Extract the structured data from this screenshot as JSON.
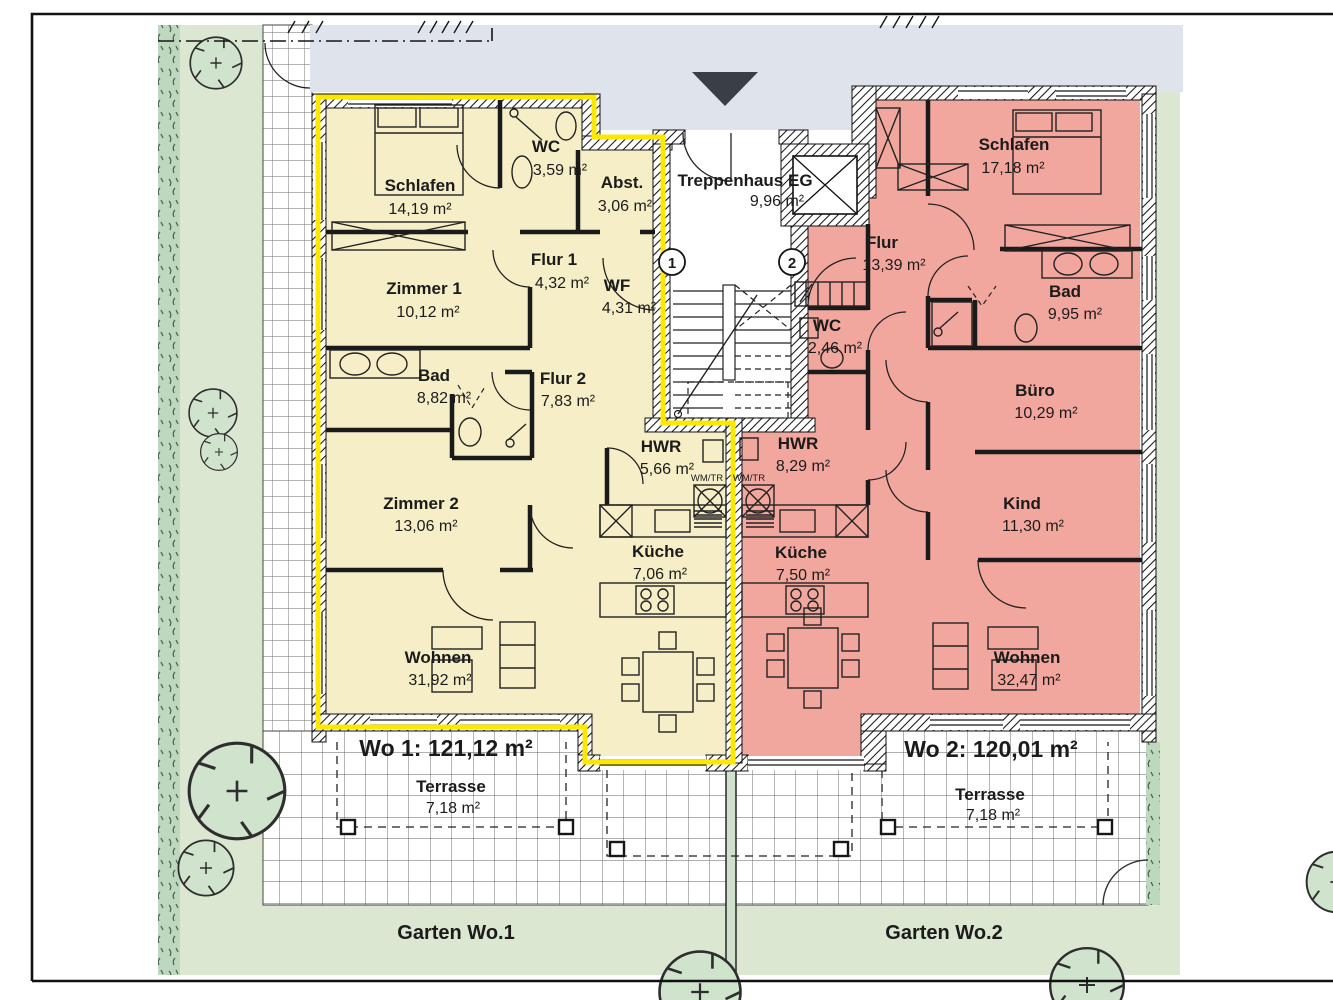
{
  "stairwell": {
    "name": "Treppenhaus EG",
    "area": "9,96 m²",
    "entrance_1": "1",
    "entrance_2": "2"
  },
  "apartment1": {
    "total": "Wo 1: 121,12 m²",
    "garden_label": "Garten Wo.1",
    "terrace": {
      "name": "Terrasse",
      "area": "7,18 m²"
    },
    "wm_label": "WM/TR",
    "rooms": {
      "schlafen": {
        "name": "Schlafen",
        "area": "14,19 m²"
      },
      "wc": {
        "name": "WC",
        "area": "3,59 m²"
      },
      "abst": {
        "name": "Abst.",
        "area": "3,06 m²"
      },
      "zimmer1": {
        "name": "Zimmer 1",
        "area": "10,12 m²"
      },
      "flur1": {
        "name": "Flur 1",
        "area": "4,32 m²"
      },
      "wf": {
        "name": "WF",
        "area": "4,31 m²"
      },
      "bad": {
        "name": "Bad",
        "area": "8,82 m²"
      },
      "flur2": {
        "name": "Flur 2",
        "area": "7,83 m²"
      },
      "zimmer2": {
        "name": "Zimmer 2",
        "area": "13,06 m²"
      },
      "hwr": {
        "name": "HWR",
        "area": "5,66 m²"
      },
      "kueche": {
        "name": "Küche",
        "area": "7,06 m²"
      },
      "wohnen": {
        "name": "Wohnen",
        "area": "31,92 m²"
      }
    }
  },
  "apartment2": {
    "total": "Wo 2: 120,01 m²",
    "garden_label": "Garten Wo.2",
    "terrace": {
      "name": "Terrasse",
      "area": "7,18 m²"
    },
    "wm_label": "WM/TR",
    "rooms": {
      "schlafen": {
        "name": "Schlafen",
        "area": "17,18 m²"
      },
      "flur": {
        "name": "Flur",
        "area": "13,39 m²"
      },
      "bad": {
        "name": "Bad",
        "area": "9,95 m²"
      },
      "wc": {
        "name": "WC",
        "area": "2,46 m²"
      },
      "buero": {
        "name": "Büro",
        "area": "10,29 m²"
      },
      "hwr": {
        "name": "HWR",
        "area": "8,29 m²"
      },
      "kind": {
        "name": "Kind",
        "area": "11,30 m²"
      },
      "kueche": {
        "name": "Küche",
        "area": "7,50 m²"
      },
      "wohnen": {
        "name": "Wohnen",
        "area": "32,47 m²"
      }
    }
  },
  "colors": {
    "apartment1_fill": "#f6eec6",
    "apartment2_fill": "#f2a79e",
    "highlight_outline": "#ffe800",
    "garden": "#dbe7d1",
    "hedge": "#bed7bf",
    "pavement": "#dfe3ec",
    "tree": "#cfe3cd"
  }
}
